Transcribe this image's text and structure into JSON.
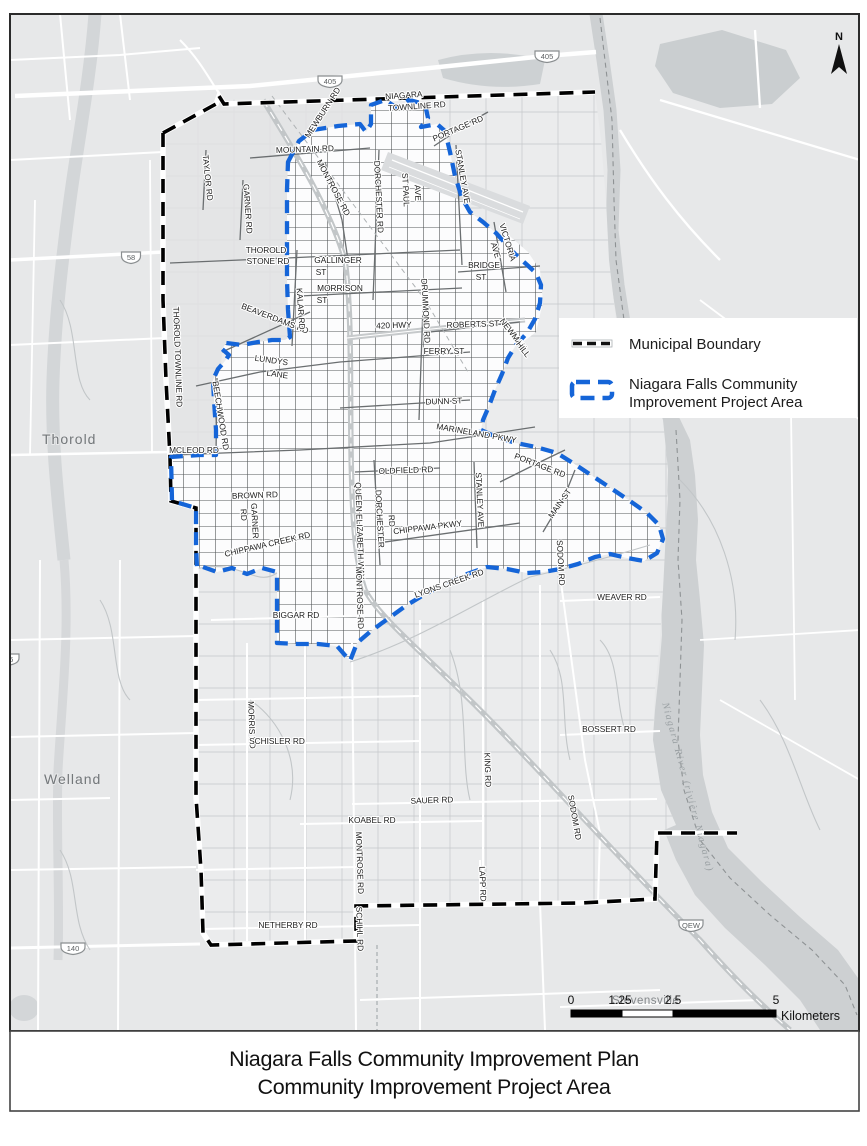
{
  "title": {
    "line1": "Niagara Falls Community Improvement Plan",
    "line2": "Community Improvement Project Area"
  },
  "north_arrow_label": "N",
  "legend": {
    "items": [
      {
        "id": "municipal-boundary",
        "label_lines": [
          "Municipal Boundary",
          ""
        ]
      },
      {
        "id": "cip-area",
        "label_lines": [
          "Niagara Falls Community",
          "Improvement Project Area"
        ]
      }
    ]
  },
  "scale_bar": {
    "tick_labels": [
      "0",
      "1.25",
      "2.5",
      "5"
    ],
    "unit_label": "Kilometers"
  },
  "colors": {
    "cip_blue": "#1565d8",
    "boundary_black": "#000000",
    "water_gray": "#cdd0d2",
    "land_gray": "#e7e8e9"
  },
  "map_labels": {
    "cities": [
      {
        "text": "Thorold",
        "x": 42,
        "y": 444
      },
      {
        "text": "Welland",
        "x": 44,
        "y": 784
      },
      {
        "text": "Stevensville",
        "x": 612,
        "y": 1004
      }
    ],
    "highway_shields": [
      {
        "text": "405",
        "x": 330,
        "y": 81
      },
      {
        "text": "405",
        "x": 547,
        "y": 56
      },
      {
        "text": "58",
        "x": 131,
        "y": 257
      },
      {
        "text": "406",
        "x": 7,
        "y": 659
      },
      {
        "text": "140",
        "x": 73,
        "y": 948
      },
      {
        "text": "QEW",
        "x": 691,
        "y": 925
      }
    ],
    "water_label": {
      "text": "Niagara River (rivière Niagara)",
      "x": 685,
      "y": 788,
      "r": 75
    },
    "roads": [
      {
        "text": "NIAGARA",
        "x": 404,
        "y": 98,
        "r": -4
      },
      {
        "text": "TOWNLINE RD",
        "x": 417,
        "y": 109,
        "r": -4
      },
      {
        "text": "MEWBURN RD",
        "x": 325,
        "y": 114,
        "r": -57
      },
      {
        "text": "MOUNTAIN RD",
        "x": 305,
        "y": 152,
        "r": -2
      },
      {
        "text": "TAYLOR RD",
        "x": 205,
        "y": 178,
        "r": 84
      },
      {
        "text": "GARNER RD",
        "x": 245,
        "y": 209,
        "r": 86
      },
      {
        "text": "MONTROSE RD",
        "x": 331,
        "y": 189,
        "r": 62
      },
      {
        "text": "DORCHESTER RD",
        "x": 376,
        "y": 197,
        "r": 87
      },
      {
        "text": "ST PAUL",
        "x": 403,
        "y": 190,
        "r": 87
      },
      {
        "text": "AVE",
        "x": 415,
        "y": 193,
        "r": 87
      },
      {
        "text": "PORTAGE RD",
        "x": 459,
        "y": 131,
        "r": -23
      },
      {
        "text": "STANLEY AVE",
        "x": 460,
        "y": 177,
        "r": 80
      },
      {
        "text": "THOROLD",
        "x": 266,
        "y": 253,
        "r": 0
      },
      {
        "text": "STONE RD",
        "x": 268,
        "y": 264,
        "r": 0
      },
      {
        "text": "GALLINGER",
        "x": 338,
        "y": 263,
        "r": 0
      },
      {
        "text": "ST",
        "x": 321,
        "y": 275,
        "r": 0
      },
      {
        "text": "MORRISON",
        "x": 340,
        "y": 291,
        "r": 0
      },
      {
        "text": "ST",
        "x": 322,
        "y": 303,
        "r": 0
      },
      {
        "text": "VICTORIA",
        "x": 505,
        "y": 243,
        "r": 73
      },
      {
        "text": "AVE",
        "x": 493,
        "y": 251,
        "r": 73
      },
      {
        "text": "BRIDGE",
        "x": 484,
        "y": 268,
        "r": 0
      },
      {
        "text": "ST",
        "x": 481,
        "y": 280,
        "r": 0
      },
      {
        "text": "BEAVERDAMS RD",
        "x": 274,
        "y": 321,
        "r": 21
      },
      {
        "text": "KALAR RD",
        "x": 298,
        "y": 309,
        "r": 86
      },
      {
        "text": "420 HWY",
        "x": 394,
        "y": 328,
        "r": -2
      },
      {
        "text": "DRUMMOND RD",
        "x": 423,
        "y": 311,
        "r": 87
      },
      {
        "text": "ROBERTS ST",
        "x": 473,
        "y": 327,
        "r": -2
      },
      {
        "text": "NEWMAN",
        "x": 511,
        "y": 336,
        "r": 52
      },
      {
        "text": "HILL",
        "x": 521,
        "y": 351,
        "r": 52
      },
      {
        "text": "FERRY ST",
        "x": 444,
        "y": 354,
        "r": 0
      },
      {
        "text": "THOROLD TOWNLINE RD",
        "x": 175,
        "y": 357,
        "r": 88
      },
      {
        "text": "LUNDYS",
        "x": 271,
        "y": 363,
        "r": 8
      },
      {
        "text": "LANE",
        "x": 277,
        "y": 377,
        "r": 8
      },
      {
        "text": "DUNN ST",
        "x": 444,
        "y": 404,
        "r": -2
      },
      {
        "text": "BEECHWOOD RD",
        "x": 218,
        "y": 416,
        "r": 81
      },
      {
        "text": "MARINELAND PKWY",
        "x": 476,
        "y": 436,
        "r": 10
      },
      {
        "text": "MCLEOD RD",
        "x": 194,
        "y": 453,
        "r": 0
      },
      {
        "text": "OLDFIELD RD",
        "x": 406,
        "y": 473,
        "r": -2
      },
      {
        "text": "PORTAGE RD",
        "x": 539,
        "y": 468,
        "r": 21
      },
      {
        "text": "STANLEY AVE",
        "x": 477,
        "y": 500,
        "r": 87
      },
      {
        "text": "MAIN ST",
        "x": 562,
        "y": 505,
        "r": -55
      },
      {
        "text": "BROWN RD",
        "x": 255,
        "y": 498,
        "r": -2
      },
      {
        "text": "GARNER",
        "x": 252,
        "y": 521,
        "r": 87
      },
      {
        "text": "RD",
        "x": 241,
        "y": 515,
        "r": 87
      },
      {
        "text": "CHIPPAWA CREEK RD",
        "x": 268,
        "y": 547,
        "r": -13
      },
      {
        "text": "QUEEN ELIZABETH WAY",
        "x": 357,
        "y": 531,
        "r": 88
      },
      {
        "text": "DORCHESTER",
        "x": 377,
        "y": 519,
        "r": 87
      },
      {
        "text": "RD",
        "x": 389,
        "y": 521,
        "r": 87
      },
      {
        "text": "CHIPPAWA PKWY",
        "x": 428,
        "y": 530,
        "r": -7
      },
      {
        "text": "SODOM RD",
        "x": 558,
        "y": 563,
        "r": 87
      },
      {
        "text": "LYONS CREEK RD",
        "x": 450,
        "y": 586,
        "r": -19
      },
      {
        "text": "MONTROSE RD",
        "x": 357,
        "y": 598,
        "r": 88
      },
      {
        "text": "BIGGAR RD",
        "x": 296,
        "y": 618,
        "r": 0
      },
      {
        "text": "WEAVER RD",
        "x": 622,
        "y": 600,
        "r": 0
      },
      {
        "text": "MORRIS RD",
        "x": 249,
        "y": 725,
        "r": 88
      },
      {
        "text": "SCHISLER RD",
        "x": 277,
        "y": 744,
        "r": 0
      },
      {
        "text": "BOSSERT RD",
        "x": 609,
        "y": 732,
        "r": 0
      },
      {
        "text": "KING RD",
        "x": 485,
        "y": 770,
        "r": 88
      },
      {
        "text": "SAUER RD",
        "x": 432,
        "y": 803,
        "r": -2
      },
      {
        "text": "KOABEL RD",
        "x": 372,
        "y": 823,
        "r": 0
      },
      {
        "text": "MONTROSE RD",
        "x": 357,
        "y": 863,
        "r": 88
      },
      {
        "text": "SODOM RD",
        "x": 572,
        "y": 818,
        "r": 80
      },
      {
        "text": "LAPP RD",
        "x": 480,
        "y": 884,
        "r": 88
      },
      {
        "text": "NETHERBY RD",
        "x": 288,
        "y": 928,
        "r": 0
      },
      {
        "text": "SCHIHL RD",
        "x": 357,
        "y": 929,
        "r": 88
      }
    ]
  }
}
